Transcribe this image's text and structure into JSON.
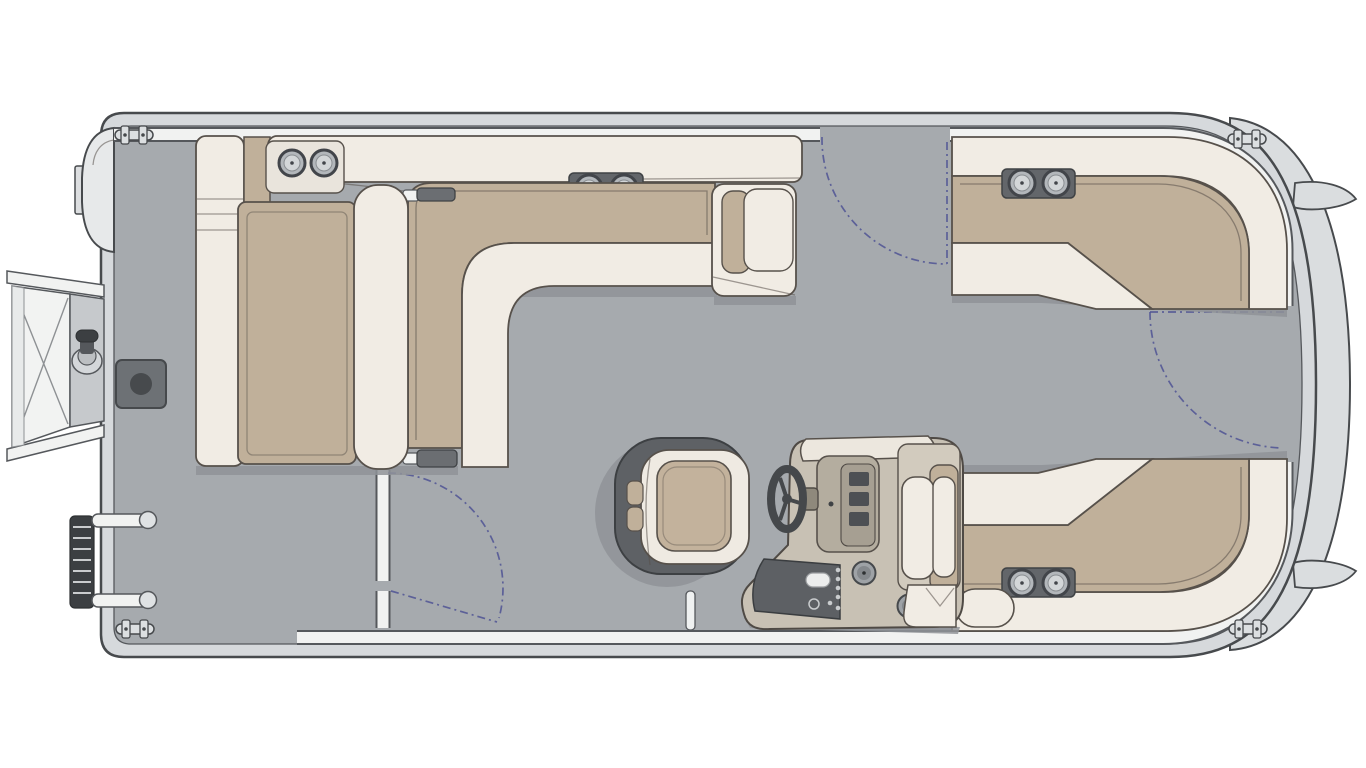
{
  "palette": {
    "background": "#ffffff",
    "hull_band": "#d6d9dc",
    "hull_outline": "#474a4d",
    "deck": "#a6aaae",
    "deck_shadow": "#8f9398",
    "fence": "#f1f2f1",
    "upholstery_cream": "#f1ece4",
    "cushion_tan": "#c0b09a",
    "panel_dark": "#63666a",
    "detail_dark": "#4a4d50",
    "console_tan": "#c8c1b4",
    "console_dark": "#b4ad9f",
    "gate_dash_blue": "#4f5394",
    "furniture_outline": "#57514b",
    "metal_light": "#dcdfe1"
  },
  "diagram": {
    "type": "pontoon-boat-floor-plan",
    "view": "top-down",
    "title": "Pontoon boat floor plan (top view)",
    "description": "Overhead line-art floor plan of a pontoon boat: wrap-around cream and tan lounge seating at bow and port side, helm console with steering wheel and captain's chair to starboard, three gate openings shown with dashed swing arcs, stern boarding door, ladder, outboard motor and four mooring cleats.",
    "orientation": {
      "bow": "right",
      "stern": "left",
      "port_side": "top",
      "starboard_side": "bottom"
    },
    "gates": [
      {
        "name": "port-entry-gate",
        "location": "port side, midship",
        "swing": "inward, hinge forward"
      },
      {
        "name": "bow-gate",
        "location": "bow centerline walkway",
        "swing": "inward, hinge port"
      },
      {
        "name": "starboard-aft-gate",
        "location": "starboard side, aft of lounge",
        "swing": "inward, hinge aft"
      }
    ],
    "seating": [
      {
        "name": "port-l-lounge",
        "style": "L-shaped bench, tan cushions with cream bolsters",
        "features": [
          "stereo speaker pair on backrest",
          "armrest end table at forward end"
        ]
      },
      {
        "name": "aft-facing-lounger",
        "style": "bench facing stern, shares backrest with port lounge"
      },
      {
        "name": "port-bow-corner-lounge",
        "style": "wrap-around corner bench",
        "features": [
          "stereo speaker pair on backrest"
        ]
      },
      {
        "name": "starboard-bow-corner-lounge",
        "style": "wrap-around corner bench with chaise end",
        "features": [
          "stereo speaker pair on backrest"
        ]
      },
      {
        "name": "captains-chair",
        "style": "swivel bucket seat, dark wrap back, tan center cushion"
      }
    ],
    "helm": {
      "name": "helm-console",
      "side": "starboard, facing bow",
      "features": [
        "steering-wheel",
        "instrument-cluster",
        "switch-panel",
        "windscreen",
        "cup-holders (2)"
      ]
    },
    "exterior_features": [
      {
        "name": "outboard-motor",
        "location": "port stern corner"
      },
      {
        "name": "stern-boarding-door",
        "detail": "fold-out door with cross bracing and pedestal mount knob"
      },
      {
        "name": "boarding-ladder",
        "location": "starboard stern corner",
        "detail": "rail with rungs and two mounting arms"
      },
      {
        "name": "mooring-cleats",
        "count": 4
      },
      {
        "name": "bow-nose-fins",
        "count": 2
      }
    ],
    "deck_fixtures": [
      {
        "name": "pedestal-seat-base",
        "shape": "dark square plate with socket",
        "location": "stern deck"
      },
      {
        "name": "pedestal-post",
        "location": "behind captains chair"
      }
    ],
    "audio": {
      "speaker_pairs": 3,
      "cup_holder_pair_on_bow_counter": 1
    }
  }
}
